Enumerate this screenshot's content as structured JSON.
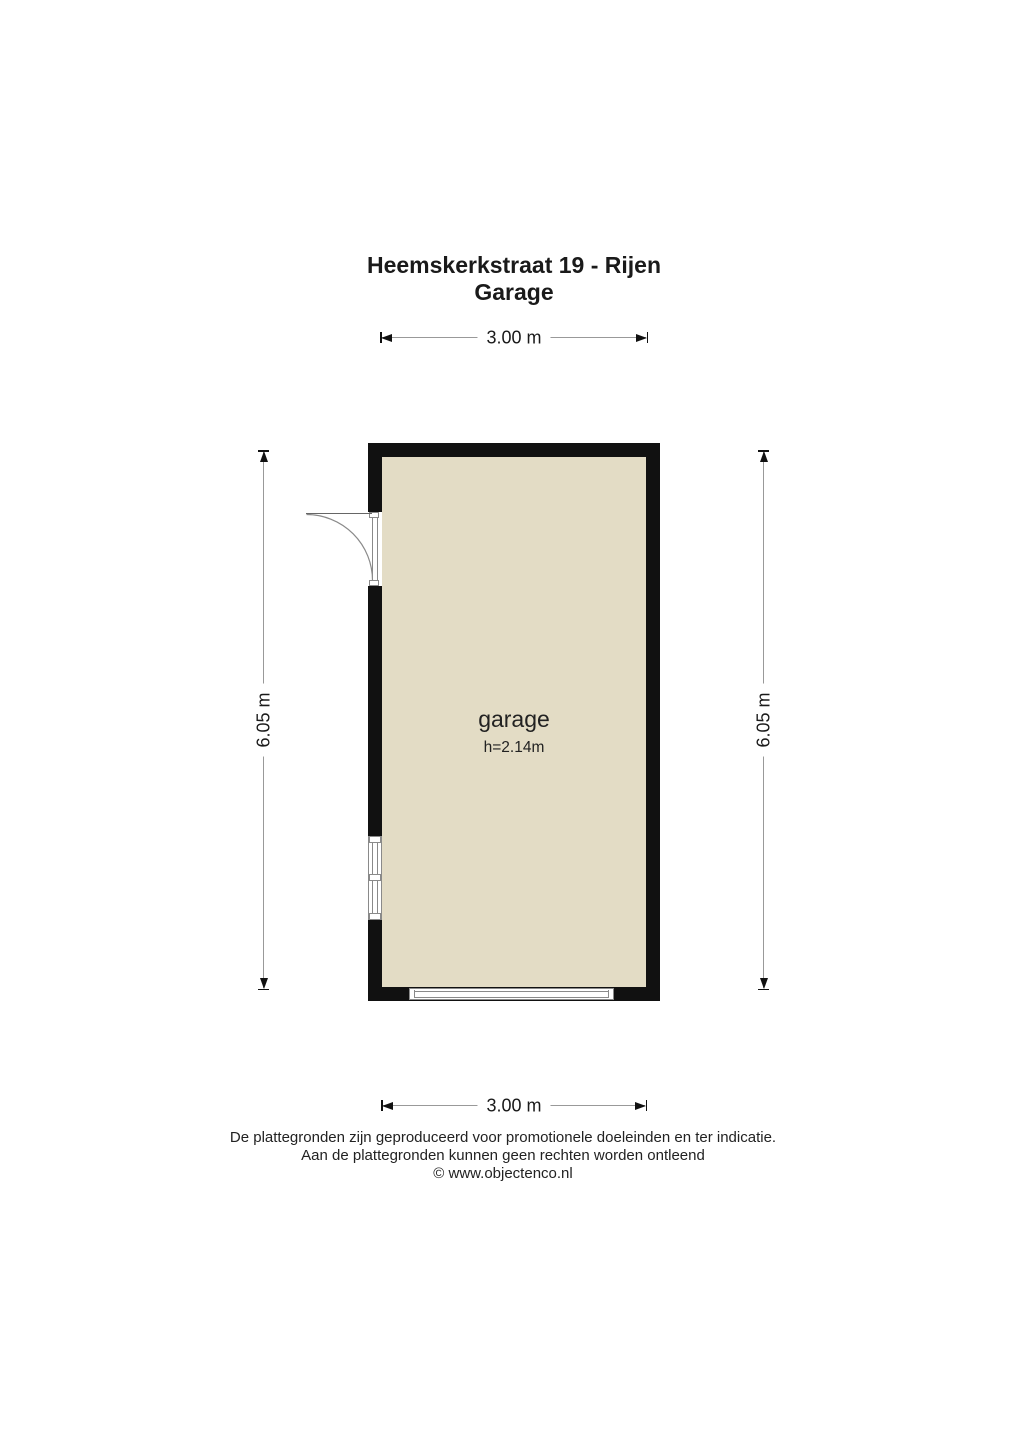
{
  "title": {
    "line1": "Heemskerkstraat 19 - Rijen",
    "line2": "Garage"
  },
  "room": {
    "name": "garage",
    "ceiling_height": "h=2.14m"
  },
  "dimensions": {
    "top": "3.00 m",
    "bottom": "3.00 m",
    "left": "6.05 m",
    "right": "6.05 m"
  },
  "footer": {
    "line1": "De plattegronden zijn geproduceerd voor promotionele doeleinden en ter indicatie.",
    "line2": "Aan de plattegronden kunnen geen rechten worden ontleend",
    "line3": "© www.objectenco.nl"
  },
  "colors": {
    "wall": "#111111",
    "floor": "#e3dcc5",
    "dimension_line": "#999999",
    "feature_line": "#8a8a8a",
    "text": "#1a1a1a"
  }
}
